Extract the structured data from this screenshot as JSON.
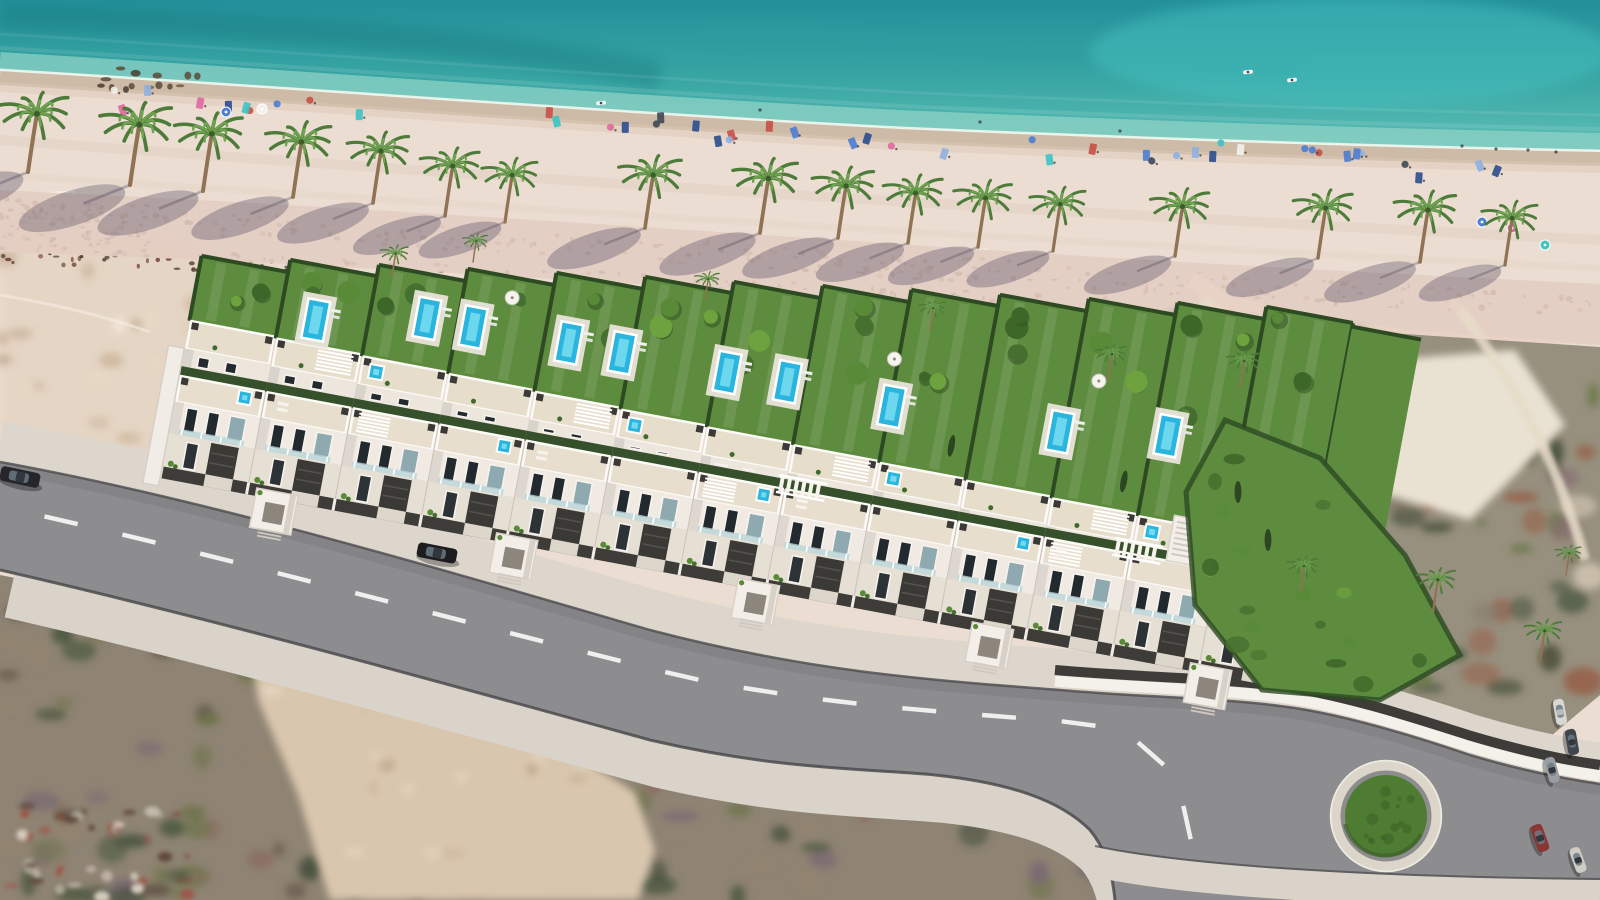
{
  "meta": {
    "width": 1600,
    "height": 900,
    "kind": "aerial-architectural-render",
    "subject": "beachfront-villa-development"
  },
  "palette": {
    "sand": "#ecddd2",
    "sea_top": "#23909a",
    "sea_low": "#5fbfb6",
    "shallow": "#8ed2c6",
    "foam": "#f0f8f1",
    "wet1": "#c9b5a0",
    "wet2": "#dcc9b6",
    "sea_streak_dark": "#177a80",
    "sea_streak_mid": "#2f9ea0",
    "sea_patch": "#46c3c3",
    "promenade": "#e3cdc2",
    "pink_path": "#e8d2c6",
    "grid_line": "#f7f1e9",
    "lawn": "#5d8c3e",
    "lawn_light": "#6fa04a",
    "hedge": "#2d4a23",
    "alley_hedge": "#35502a",
    "pool_water": "#2ab5de",
    "pool_light": "#74daf0",
    "pool_deck": "#e9e4da",
    "white_wall": "#f3efe8",
    "face_light": "#f0eae2",
    "face_mid": "#e6dfd4",
    "face_back": "#ece6dd",
    "terrace": "#e8decd",
    "terrace_back": "#e7ddcb",
    "parapet": "#fbfaf7",
    "charcoal": "#3b3936",
    "fence": "#3e3c38",
    "window": "#232a2f",
    "glass": "#b9d4d8",
    "door_glass": "#8fa9b0",
    "asphalt": "#8d8c8e",
    "sidewalk": "#dcd6cc",
    "sidewalk2": "#d9d3c9",
    "curb": "#4b4a4c",
    "dash": "#f4f4f2",
    "rb_green": "#4e7c33",
    "rb_green_dark": "#3a5d26",
    "rb_ring": "#dcd6ca",
    "rb_ring2": "#ecebe2",
    "scrub_left_base": "#8f8473",
    "scrub_right_base": "#97907e",
    "sand_wedge": "#d9c6ae",
    "left_sand": "#e2d0bc",
    "trunk": "#8f7354",
    "frond_dark": "#4d7b3a",
    "frond_light": "#6fa351",
    "palm_shadow": "rgba(72,62,88,0.32)",
    "debris": [
      "#6a4038",
      "#7b4b41",
      "#523a31",
      "#8c5c4b",
      "#3f322c"
    ],
    "towels": [
      "#4f7fd0",
      "#f2f0ea",
      "#e06aa0",
      "#3fc3c3",
      "#2f4f8f",
      "#c8524a",
      "#8fb2e0",
      "#444a55"
    ],
    "scrub_left_blobs": [
      "#6e744c",
      "#4c5940",
      "#8a7062",
      "#5d4f41",
      "#93836f",
      "#3e4a38",
      "#7b6a73"
    ],
    "scrub_right_blobs": [
      "#857b6a",
      "#6e7a4e",
      "#4a523e",
      "#8a6e74",
      "#96604a",
      "#d9cdb9",
      "#55604a"
    ],
    "bush_greens": [
      "#46702f",
      "#588a38",
      "#6da23f",
      "#3d6629"
    ],
    "car_colors": [
      "#d8d7d2",
      "#41454c",
      "#9a9da1",
      "#8a3632",
      "#cfccc6"
    ]
  },
  "sea": {
    "poly": "M0,0 H1600 V151 C1400,147 1150,139 900,128 C600,112 300,88 0,70 Z",
    "shore": "M0,70 C300,88 600,112 900,128 C1150,139 1400,147 1600,151",
    "streak1": "M0,16 C300,26 520,46 660,76",
    "streak2": "M700,30 C900,44 1100,60 1300,72",
    "patch": {
      "cx": 1350,
      "cy": 52,
      "rx": 260,
      "ry": 55
    },
    "shore_y0": 70,
    "shore_slope": 0.0506,
    "boats": [
      [
        601,
        103
      ],
      [
        1248,
        72
      ],
      [
        1292,
        80
      ]
    ],
    "swimmers": [
      [
        1462,
        146
      ],
      [
        1496,
        149
      ],
      [
        1528,
        150
      ],
      [
        1556,
        152
      ],
      [
        760,
        110
      ],
      [
        980,
        122
      ],
      [
        1120,
        131
      ]
    ]
  },
  "beach": {
    "spit": {
      "x0": 92,
      "x1": 205,
      "y0": 68,
      "y1": 92,
      "n": 14
    },
    "left_sand_poly": [
      [
        0,
        215
      ],
      [
        150,
        230
      ],
      [
        390,
        300
      ],
      [
        420,
        420
      ],
      [
        300,
        520
      ],
      [
        0,
        470
      ]
    ],
    "left_track": "M0,295 C60,305 110,318 150,332",
    "grid": {
      "x0": 44,
      "y0": 197,
      "dx": 38,
      "dy": 2.42,
      "n": 40,
      "w": 30,
      "h": 17,
      "rot": -4,
      "skip": 0.22
    },
    "debris_bands": [
      {
        "x0": 0,
        "x1": 1600,
        "y0": 210,
        "slope": 0.062,
        "spread": 12,
        "n": 260
      },
      {
        "x0": 0,
        "x1": 1120,
        "y0": 252,
        "slope": 0.05,
        "spread": 10,
        "n": 170
      },
      {
        "x0": 0,
        "x1": 150,
        "y0": 225,
        "slope": 0.0,
        "spread": 22,
        "n": 80
      }
    ],
    "towels": {
      "x0": 110,
      "x1": 1590,
      "n": 46,
      "offset": 24,
      "spread": 13
    },
    "parasols": [
      [
        1512,
        228,
        "#e06aa0"
      ],
      [
        1545,
        245,
        "#3fc3c3"
      ],
      [
        1482,
        222,
        "#4f7fd0"
      ],
      [
        226,
        112,
        "#4f7fd0"
      ],
      [
        262,
        109,
        "#f2f0ea"
      ]
    ]
  },
  "promenade": {
    "poly": "M0,190 C300,204 600,224 900,244 C1100,258 1350,272 1600,284 L1600,345 C1350,332 1100,312 900,300 C600,282 300,262 0,252 Z",
    "pink_paths": [
      {
        "d": "M1190,280 C1260,320 1320,380 1350,470 C1370,530 1360,600 1330,650",
        "w": 16
      },
      {
        "d": "M1450,300 C1520,370 1560,460 1580,560",
        "w": 11
      },
      {
        "d": "M1230,300 C1330,330 1440,340 1560,345",
        "w": 10
      }
    ]
  },
  "scrub_left": {
    "poly": [
      [
        0,
        575
      ],
      [
        240,
        622
      ],
      [
        480,
        690
      ],
      [
        660,
        728
      ],
      [
        790,
        753
      ],
      [
        900,
        762
      ],
      [
        1010,
        778
      ],
      [
        1070,
        806
      ],
      [
        1100,
        840
      ],
      [
        1115,
        900
      ],
      [
        0,
        900
      ]
    ],
    "n_blobs": 120,
    "sand_wedge": [
      [
        250,
        645
      ],
      [
        420,
        695
      ],
      [
        555,
        742
      ],
      [
        635,
        792
      ],
      [
        655,
        850
      ],
      [
        638,
        900
      ],
      [
        330,
        900
      ],
      [
        298,
        795
      ],
      [
        258,
        700
      ]
    ],
    "rubble": {
      "poly": [
        [
          8,
          800
        ],
        [
          180,
          812
        ],
        [
          195,
          898
        ],
        [
          5,
          898
        ]
      ],
      "n": 40,
      "colors": [
        "#a44b3e",
        "#c8beb2",
        "#7e4a3c",
        "#e0d6c8",
        "#5c4438"
      ]
    }
  },
  "scrub_right": {
    "poly": [
      [
        1075,
        312
      ],
      [
        1600,
        347
      ],
      [
        1600,
        695
      ],
      [
        1520,
        762
      ],
      [
        1430,
        722
      ],
      [
        1330,
        700
      ],
      [
        1240,
        692
      ],
      [
        1185,
        640
      ],
      [
        1160,
        540
      ],
      [
        1120,
        420
      ]
    ],
    "n_blobs": 110,
    "parking_patch": [
      [
        1285,
        368
      ],
      [
        1515,
        350
      ],
      [
        1565,
        425
      ],
      [
        1470,
        520
      ],
      [
        1300,
        468
      ]
    ],
    "car_rows": [
      {
        "x0": 1180,
        "y0": 332,
        "dx": 17,
        "dy": 1.5,
        "n": 13,
        "w": 13,
        "h": 6,
        "rot": 12
      },
      {
        "x0": 1225,
        "y0": 420,
        "dx": 16,
        "dy": 1.2,
        "n": 9,
        "w": 13,
        "h": 6,
        "rot": 12
      }
    ],
    "paths": [
      {
        "d": "M1200,300 C1280,360 1330,420 1350,500",
        "w": 14
      },
      {
        "d": "M1350,500 C1355,560 1330,620 1290,660",
        "w": 12
      },
      {
        "d": "M1460,310 C1520,390 1560,470 1585,560",
        "w": 10
      }
    ]
  },
  "garden_right_end": {
    "poly": [
      [
        1225,
        420
      ],
      [
        1320,
        458
      ],
      [
        1405,
        555
      ],
      [
        1460,
        655
      ],
      [
        1380,
        700
      ],
      [
        1262,
        690
      ],
      [
        1195,
        605
      ],
      [
        1186,
        492
      ]
    ],
    "n_bushes": 18,
    "cypresses": [
      [
        1238,
        492
      ],
      [
        1268,
        540
      ]
    ]
  },
  "road": {
    "top_edge": "M0,462 C200,498 430,566 650,630 C810,672 930,680 1060,690 C1140,697 1220,698 1280,706 C1340,713 1420,738 1470,755 C1520,770 1560,778 1600,784",
    "bottom_edge": "M0,570 C210,618 440,682 650,740 C780,770 860,768 935,775 C1010,783 1060,800 1090,830 C1105,848 1112,870 1115,900",
    "asphalt": "M0,462 C200,498 430,566 650,630 C810,672 930,680 1060,690 C1140,697 1220,698 1280,706 C1340,713 1420,738 1470,755 C1520,770 1560,778 1600,784 L1600,900 L1115,900 C1112,870 1105,848 1090,830 C1060,800 1010,783 935,775 C860,768 780,770 650,740 C440,682 210,618 0,570 Z",
    "centerline": "M25,512 C240,560 470,625 690,678 C830,706 950,712 1070,722 C1130,727 1165,755 1178,790 C1186,812 1190,830 1192,850",
    "dash_len": 34,
    "dash_gap": 80,
    "dash_w": 4.5,
    "bottom_walk": "M1095,862 C1200,884 1400,893 1600,895",
    "s_white": "M1055,681 C1135,688 1215,689 1278,697 C1338,704 1415,729 1468,746 C1518,761 1558,770 1600,776",
    "roundabout": {
      "cx": 1386,
      "cy": 816,
      "r_green": 41,
      "r_ring": 50,
      "r_outer": 55,
      "n_texture": 14
    }
  },
  "complex": {
    "tx": 160,
    "ty": 478,
    "angle": 10.6,
    "units": {
      "count": 13,
      "w": 88,
      "backY0": -160,
      "backYStep": 1.6,
      "depths": [
        66,
        80,
        93,
        107,
        121,
        135,
        148,
        162,
        176,
        189,
        203,
        217,
        231
      ]
    },
    "pools": [
      [
        124,
        -184
      ],
      [
        233,
        -206
      ],
      [
        280,
        -206
      ],
      [
        377,
        -208
      ],
      [
        431,
        -208
      ],
      [
        538,
        -208
      ],
      [
        599,
        -210
      ],
      [
        706,
        -205
      ],
      [
        876,
        -211
      ],
      [
        983,
        -227
      ]
    ],
    "portals": [
      118,
      362,
      608,
      846,
      1068
    ],
    "jacuzzi_back": [
      2,
      5,
      8,
      11
    ],
    "jacuzzi_front": [
      0,
      3,
      6,
      9,
      12
    ],
    "pergola_back": [
      1,
      4,
      7,
      10
    ],
    "pergola_front": [
      2,
      6,
      10
    ],
    "roof_loungers": [
      1,
      4,
      7,
      10
    ],
    "bridges": [
      610,
      952
    ],
    "parasols": [
      [
        313,
        -242
      ],
      [
        700,
        -252
      ],
      [
        905,
        -268
      ]
    ],
    "cypress_units": [
      8,
      10,
      11
    ],
    "stairs": {
      "x": 1004,
      "y": -150,
      "w": 48,
      "h": 46,
      "steps": 7
    },
    "left_wall": {
      "x": -16,
      "y": -132,
      "w": 16,
      "h": 140
    },
    "end_lawn": {
      "x": 1144,
      "y": -368,
      "w": 70,
      "h": 228
    }
  },
  "palms": {
    "main": [
      [
        28,
        172,
        1.12
      ],
      [
        130,
        185,
        1.16
      ],
      [
        203,
        191,
        1.1
      ],
      [
        293,
        197,
        1.06
      ],
      [
        373,
        203,
        1.0
      ],
      [
        445,
        216,
        0.96
      ],
      [
        505,
        222,
        0.9
      ],
      [
        645,
        228,
        1.02
      ],
      [
        760,
        233,
        1.05
      ],
      [
        838,
        238,
        1.0
      ],
      [
        908,
        243,
        0.96
      ],
      [
        978,
        247,
        0.94
      ],
      [
        1053,
        251,
        0.9
      ],
      [
        1175,
        256,
        0.95
      ],
      [
        1318,
        258,
        0.96
      ],
      [
        1420,
        262,
        1.0
      ],
      [
        1505,
        265,
        0.9
      ]
    ],
    "small": [
      [
        392,
        277,
        0.45
      ],
      [
        473,
        262,
        0.4
      ],
      [
        1240,
        388,
        0.52
      ],
      [
        705,
        300,
        0.4
      ],
      [
        930,
        330,
        0.42
      ],
      [
        1108,
        380,
        0.5
      ],
      [
        1300,
        592,
        0.5
      ],
      [
        1433,
        612,
        0.62
      ],
      [
        1540,
        662,
        0.6
      ],
      [
        1566,
        575,
        0.42
      ]
    ]
  },
  "vehicles": [
    {
      "x": 20,
      "y": 477,
      "rot": 12,
      "color": "#26262a",
      "len": 40,
      "wid": 15,
      "kind": "sedan-parked-roadside"
    },
    {
      "x": 437,
      "y": 553,
      "rot": 11,
      "color": "#1d1d20",
      "len": 40,
      "wid": 15,
      "kind": "sedan-driveway"
    },
    {
      "x": 1560,
      "y": 712,
      "rot": 80,
      "color": "#d8d7d2",
      "len": 26,
      "wid": 11,
      "kind": "parked"
    },
    {
      "x": 1572,
      "y": 742,
      "rot": 80,
      "color": "#41454c",
      "len": 26,
      "wid": 11,
      "kind": "parked"
    },
    {
      "x": 1552,
      "y": 770,
      "rot": 75,
      "color": "#9a9da1",
      "len": 26,
      "wid": 11,
      "kind": "parked"
    },
    {
      "x": 1540,
      "y": 838,
      "rot": 70,
      "color": "#8a3632",
      "len": 28,
      "wid": 12,
      "kind": "parked"
    },
    {
      "x": 1578,
      "y": 860,
      "rot": 70,
      "color": "#cfccc6",
      "len": 26,
      "wid": 11,
      "kind": "parked"
    }
  ],
  "seeds": {
    "debris": 7,
    "towels": 11,
    "scrubL": 23,
    "scrubR": 31,
    "gardens": 41,
    "bushes": 53,
    "mottle": 61
  }
}
